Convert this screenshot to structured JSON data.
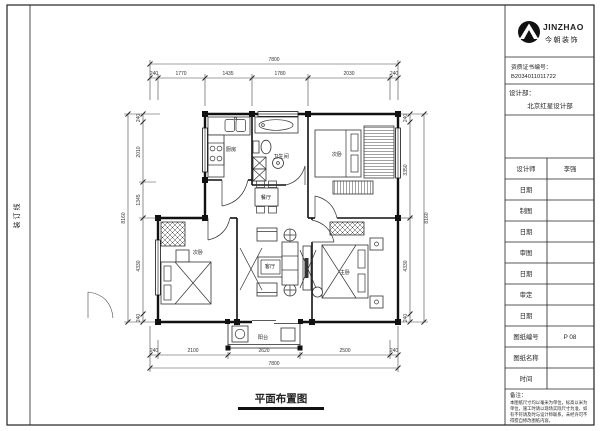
{
  "sheet": {
    "binding_line": "装订线"
  },
  "title_block": {
    "brand": {
      "name": "JINZHAO",
      "name_cn": "今朝装饰",
      "logo_icon": "mountain-in-circle"
    },
    "certificate": {
      "label": "资质证书编号：",
      "number": "B2034011011722"
    },
    "department": {
      "label": "设计部：",
      "value": "北京红星设计部"
    },
    "rows": [
      {
        "label": "设计师",
        "value": "李强"
      },
      {
        "label": "日期",
        "value": ""
      },
      {
        "label": "制图",
        "value": ""
      },
      {
        "label": "日期",
        "value": ""
      },
      {
        "label": "审图",
        "value": ""
      },
      {
        "label": "日期",
        "value": ""
      },
      {
        "label": "审定",
        "value": ""
      },
      {
        "label": "日期",
        "value": ""
      },
      {
        "label": "图纸编号",
        "value": "P 08"
      },
      {
        "label": "图纸名称",
        "value": ""
      },
      {
        "label": "时间",
        "value": ""
      }
    ],
    "notes": {
      "label": "备注：",
      "lines": [
        "本图纸尺寸均以毫米为单位，标高以米为",
        "单位，施工时请以现场实际尺寸为准，如",
        "有不符请及时与设计师联系，未经许可不",
        "得擅自修改图纸内容。"
      ]
    }
  },
  "floor_plan": {
    "title": "平面布置图",
    "rooms": {
      "kitchen": "厨房",
      "bathroom": "卫生间",
      "bedroom2": "次卧",
      "dining": "餐厅",
      "living": "客厅",
      "bedroom3": "次卧",
      "master": "主卧",
      "balcony": "阳台"
    },
    "dimensions": {
      "top": {
        "overall": "7800",
        "segments": [
          "240",
          "1770",
          "1435",
          "1780",
          "2030",
          "240"
        ]
      },
      "bottom": {
        "overall": "7800",
        "segments": [
          "240",
          "2100",
          "2620",
          "2500",
          "240"
        ]
      },
      "left": {
        "overall": "8160",
        "segments": [
          "240",
          "2010",
          "1345",
          "4330",
          "240"
        ]
      },
      "right": {
        "overall": "8160",
        "segments": [
          "240",
          "3350",
          "4330",
          "240"
        ]
      }
    }
  }
}
